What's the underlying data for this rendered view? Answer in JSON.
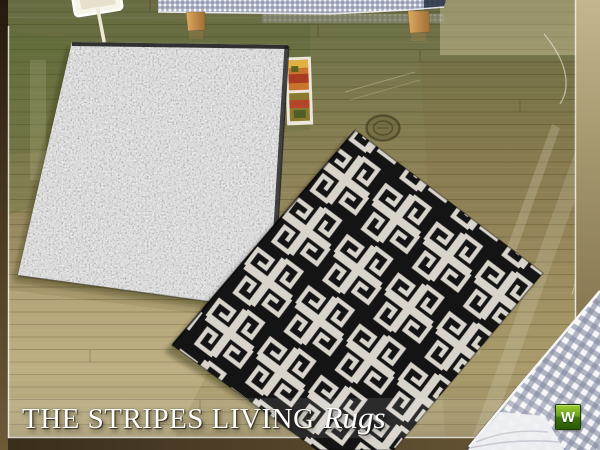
{
  "title": {
    "main": "THE STRIPES LIVING",
    "script": "Rugs"
  },
  "watermark": {
    "label": "W"
  },
  "colors": {
    "watermark_green": "#6fa51c",
    "floor_olive_top": "#6e7046",
    "floor_tan_bottom": "#b3a678",
    "black_rug": "#161616",
    "rug_motif_white": "#d8d4cc",
    "gray_rug": "#d2d2d2",
    "gingham_blue": "#9aa2b8",
    "wood_leg": "#c08a4a"
  }
}
